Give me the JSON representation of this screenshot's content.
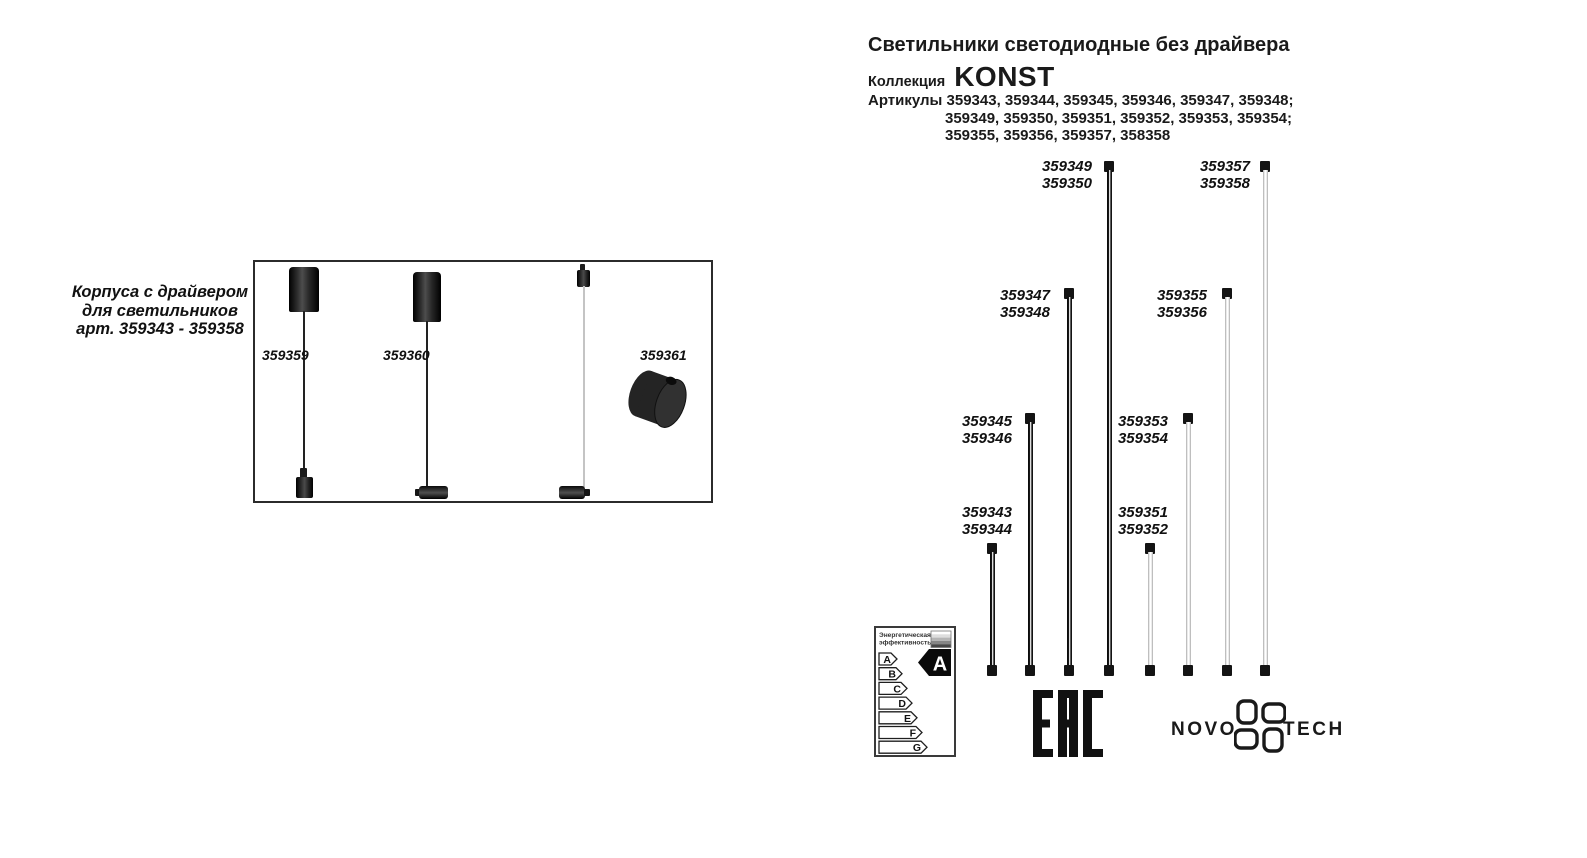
{
  "colors": {
    "ink": "#1a1a1a",
    "background": "#ffffff"
  },
  "left_panel": {
    "caption": {
      "line1": "Корпуса с драйвером",
      "line2": "для светильников",
      "line3": "арт. 359343 - 359358"
    },
    "items": [
      {
        "article": "359359"
      },
      {
        "article": "359360"
      },
      {
        "article": "359361"
      }
    ]
  },
  "header": {
    "title": "Светильники светодиодные без драйвера",
    "collection_label": "Коллекция",
    "collection_name": "KONST",
    "articles_label": "Артикулы",
    "articles_line1": "359343, 359344, 359345, 359346, 359347, 359348;",
    "articles_line2": "359349, 359350, 359351, 359352, 359353, 359354;",
    "articles_line3": "359355, 359356, 359357, 358358"
  },
  "rods": [
    {
      "finish": "black",
      "labels": [
        "359343",
        "359344"
      ]
    },
    {
      "finish": "black",
      "labels": [
        "359345",
        "359346"
      ]
    },
    {
      "finish": "black",
      "labels": [
        "359347",
        "359348"
      ]
    },
    {
      "finish": "black",
      "labels": [
        "359349",
        "359350"
      ]
    },
    {
      "finish": "white",
      "labels": [
        "359351",
        "359352"
      ]
    },
    {
      "finish": "white",
      "labels": [
        "359353",
        "359354"
      ]
    },
    {
      "finish": "white",
      "labels": [
        "359355",
        "359356"
      ]
    },
    {
      "finish": "white",
      "labels": [
        "359357",
        "359358"
      ]
    }
  ],
  "energy_label": {
    "header_line1": "Энергетическая",
    "header_line2": "эффективность",
    "classes": [
      "A",
      "B",
      "C",
      "D",
      "E",
      "F",
      "G"
    ],
    "rating": "A"
  },
  "certification": {
    "eac": "ЕАС"
  },
  "brand": {
    "name_left": "NOVO",
    "name_right": "TECH"
  }
}
